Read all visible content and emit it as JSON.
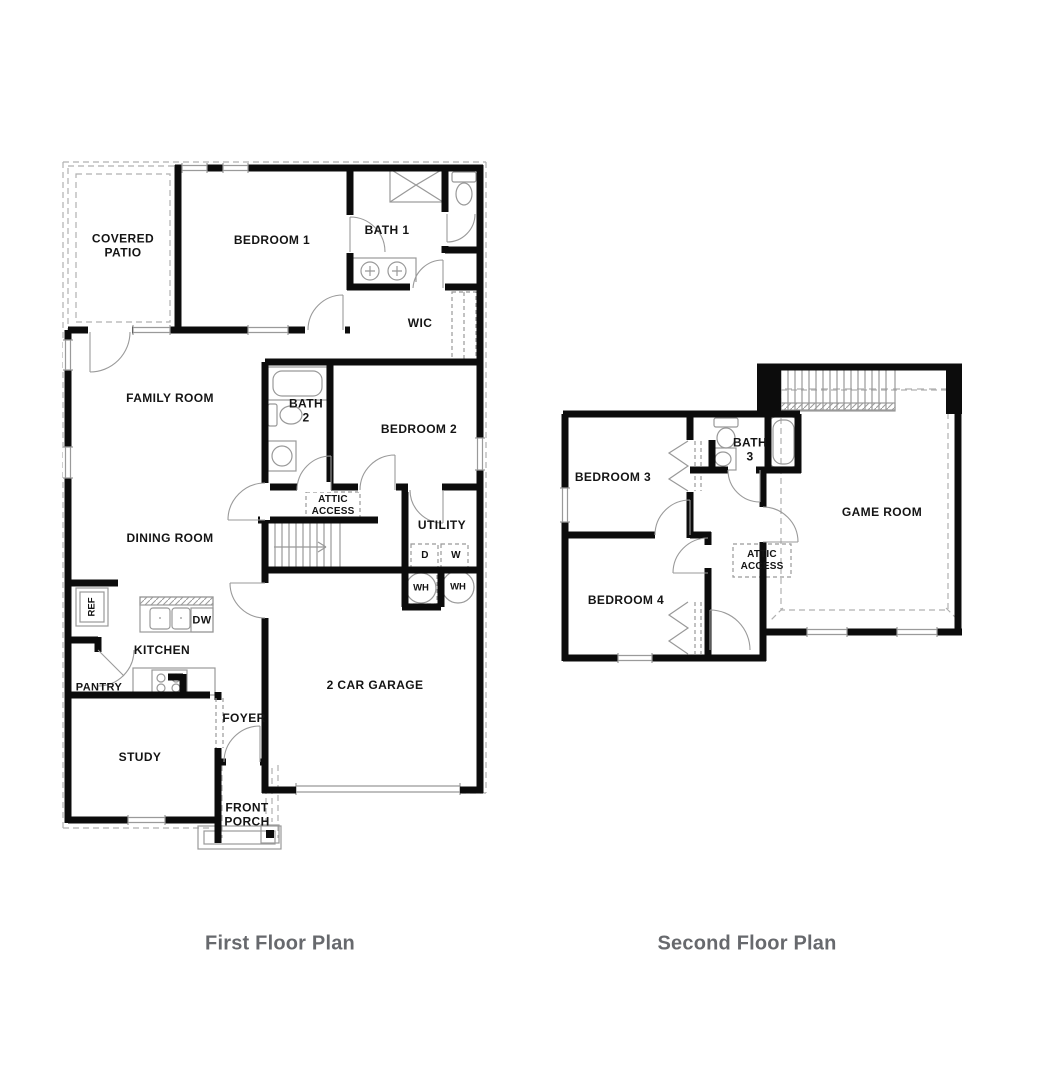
{
  "first_floor": {
    "title": "First Floor Plan",
    "labels": {
      "covered_patio": "COVERED PATIO",
      "bedroom_1": "BEDROOM 1",
      "bath_1": "BATH 1",
      "wic": "WIC",
      "family_room": "FAMILY ROOM",
      "bath_2": "BATH 2",
      "bedroom_2": "BEDROOM 2",
      "attic_access": "ATTIC ACCESS",
      "dining_room": "DINING ROOM",
      "utility": "UTILITY",
      "dryer": "D",
      "washer": "W",
      "water_heater_left": "WH",
      "water_heater_right": "WH",
      "refrigerator": "REF",
      "dishwasher": "DW",
      "kitchen": "KITCHEN",
      "pantry": "PANTRY",
      "study": "STUDY",
      "foyer": "FOYER",
      "front_porch": "FRONT PORCH",
      "garage": "2 CAR GARAGE"
    }
  },
  "second_floor": {
    "title": "Second Floor Plan",
    "labels": {
      "bedroom_3": "BEDROOM 3",
      "bath_3": "BATH 3",
      "game_room": "GAME ROOM",
      "attic_access": "ATTIC ACCESS",
      "bedroom_4": "BEDROOM 4"
    }
  },
  "colors": {
    "background": "#ffffff",
    "wall": "#0c0c0c",
    "fixture": "#999999",
    "dashed": "#b0b0b0",
    "label": "#141414",
    "title": "#67696d"
  }
}
